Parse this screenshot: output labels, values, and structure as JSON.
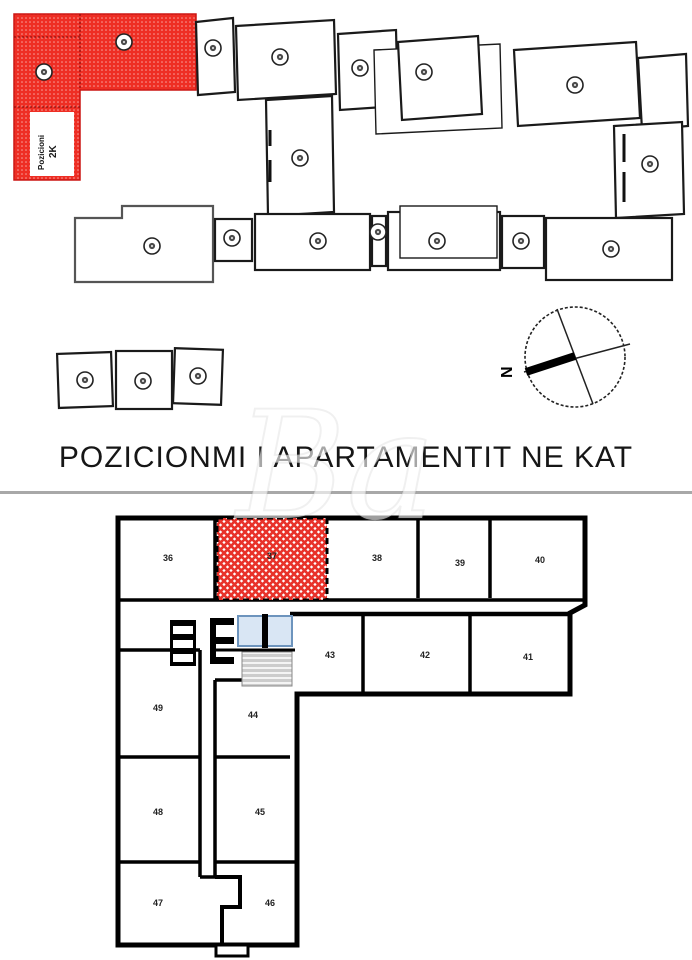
{
  "page": {
    "title": "POZICIONMI I APARTAMENTIT NE KAT",
    "watermark_text": "Ba"
  },
  "site_plan": {
    "highlight_label": {
      "line1": "Pozicioni",
      "line2": "2K"
    },
    "compass_letter": "N",
    "colors": {
      "highlight_red": "#ee2e24",
      "outline": "#1a1a1a"
    }
  },
  "floor_plan": {
    "highlighted_room": "37",
    "colors": {
      "highlight_red": "#e8322a",
      "elevator_blue_fill": "#d9e6f4",
      "elevator_blue_stroke": "#6d94bd",
      "stairs_gray": "#cccccc",
      "wall_black": "#000000"
    },
    "rooms": {
      "r36": "36",
      "r37": "37",
      "r38": "38",
      "r39": "39",
      "r40": "40",
      "r41": "41",
      "r42": "42",
      "r43": "43",
      "r44": "44",
      "r45": "45",
      "r46": "46",
      "r47": "47",
      "r48": "48",
      "r49": "49"
    }
  }
}
